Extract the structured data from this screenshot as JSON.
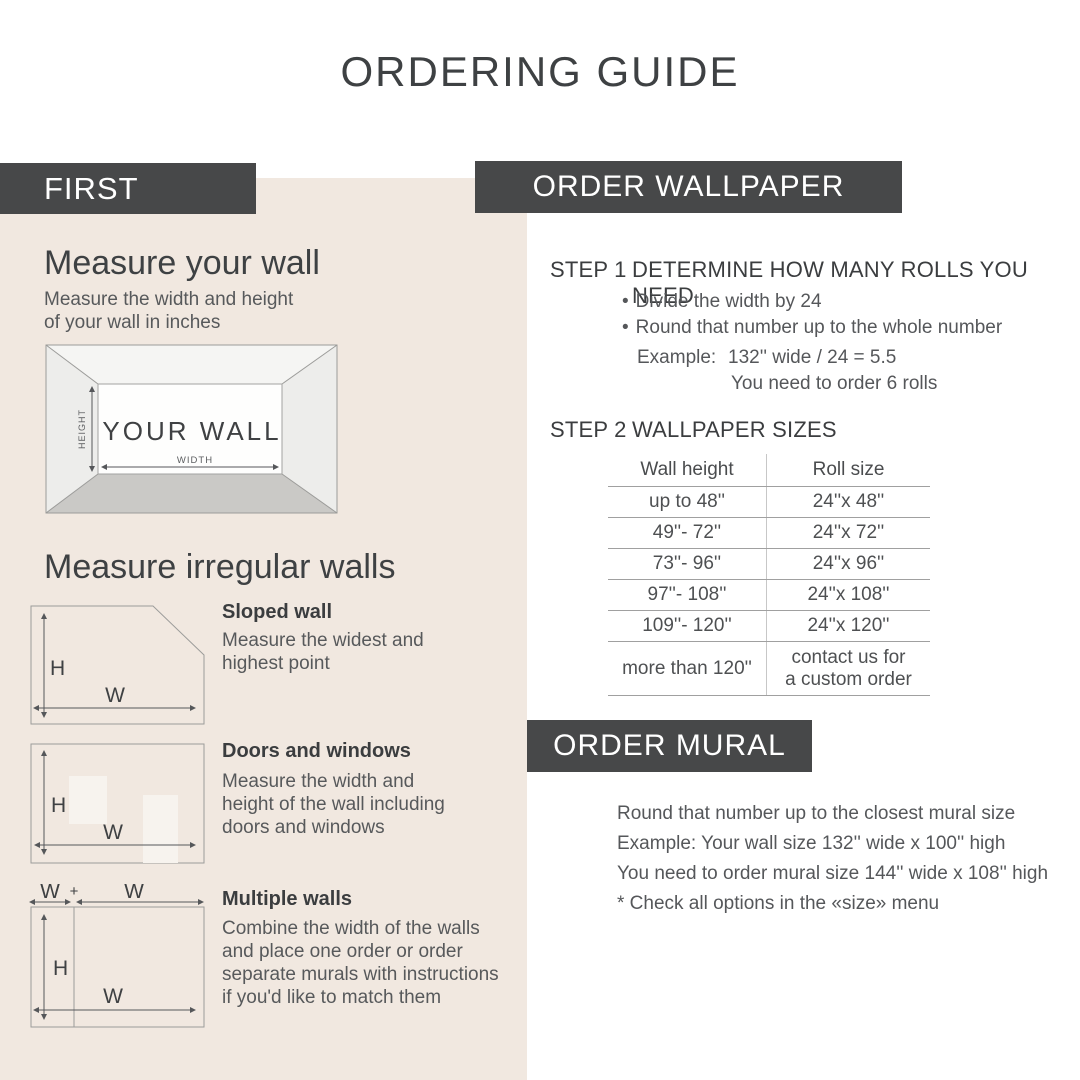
{
  "title": "ORDERING GUIDE",
  "left": {
    "header": "FIRST",
    "measure_wall": {
      "heading": "Measure your wall",
      "description": "Measure the width and height\nof your wall in inches",
      "diagram": {
        "wall": "YOUR WALL",
        "height": "HEIGHT",
        "width": "WIDTH"
      }
    },
    "irregular": {
      "heading": "Measure irregular walls",
      "labels": {
        "h": "H",
        "w": "W",
        "plus": "+"
      },
      "items": [
        {
          "title": "Sloped wall",
          "description": "Measure the widest and\nhighest point"
        },
        {
          "title": "Doors and windows",
          "description": "Measure the width and\nheight of the wall including\ndoors and windows"
        },
        {
          "title": "Multiple walls",
          "description": "Combine the width of the walls\nand place one order or order\nseparate murals with instructions\nif you'd like to match them"
        }
      ]
    }
  },
  "wallpaper": {
    "header": "ORDER WALLPAPER",
    "step1": {
      "label": "STEP 1",
      "title": "DETERMINE HOW MANY ROLLS YOU NEED",
      "bullet_char": "•",
      "bullets": [
        "Divide the width by 24",
        "Round that number up to the whole number"
      ],
      "example_label": "Example:",
      "example_value": "132'' wide / 24 = 5.5",
      "example_note": "You need to order 6 rolls"
    },
    "step2": {
      "label": "STEP 2",
      "title": "WALLPAPER SIZES",
      "table": {
        "headers": [
          "Wall height",
          "Roll size"
        ],
        "rows": [
          [
            "up to 48''",
            "24''x 48''"
          ],
          [
            "49''- 72''",
            "24''x 72''"
          ],
          [
            "73''- 96''",
            "24''x 96''"
          ],
          [
            "97''- 108''",
            "24''x 108''"
          ],
          [
            "109''- 120''",
            "24''x 120''"
          ],
          [
            "more than 120''",
            "contact us for\na custom order"
          ]
        ]
      }
    }
  },
  "mural": {
    "header": "ORDER MURAL",
    "lines": [
      "Round that number up to the closest mural size",
      "Example: Your wall size 132'' wide x 100'' high",
      "You need to order mural size 144'' wide x 108'' high",
      "* Check all options in the «size» menu"
    ]
  },
  "colors": {
    "bar": "#474849",
    "beige": "#f1e8e0",
    "text_dark": "#3e4143",
    "text_gray": "#57595b"
  }
}
